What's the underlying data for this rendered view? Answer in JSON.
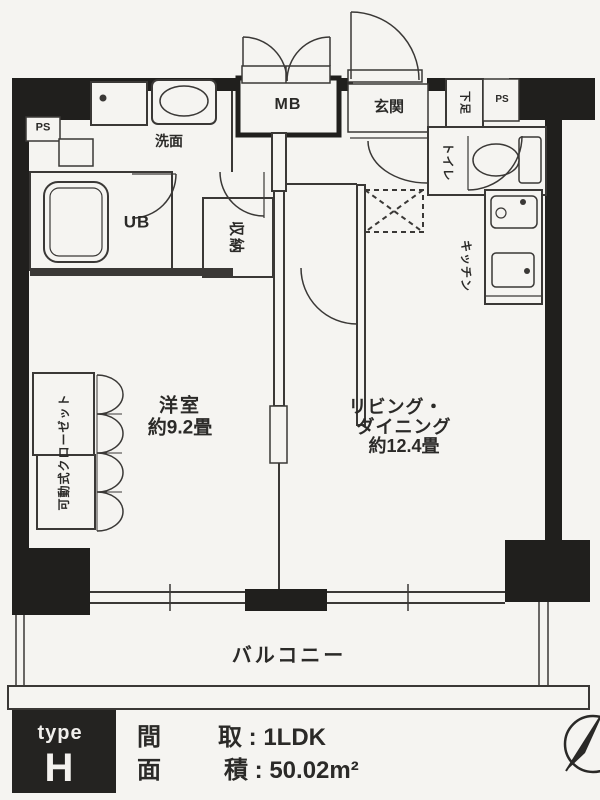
{
  "plan": {
    "labels": {
      "mb": "MB",
      "genkan": "玄関",
      "geta": "下足",
      "ps_right": "PS",
      "ps_left": "PS",
      "senmen": "洗面",
      "ub": "UB",
      "shuno": "収納",
      "toilet": "トイレ",
      "kitchen": "キッチン",
      "closet": "可動式クローゼット",
      "western_room": "洋室",
      "western_room_size": "約9.2畳",
      "living_line1": "リビング・",
      "living_line2": "ダイニング",
      "living_size": "約12.4畳",
      "balcony": "バルコニー"
    }
  },
  "legend": {
    "type_label": "type",
    "type_value": "H",
    "madori_char": "間",
    "menseki_char": "面",
    "layout_line": "取 : 1LDK",
    "area_line": "積 : 50.02m²"
  },
  "colors": {
    "paper": "#f5f4f1",
    "wall": "#201f1d",
    "line": "#3a3836",
    "text": "#2b2a28"
  }
}
